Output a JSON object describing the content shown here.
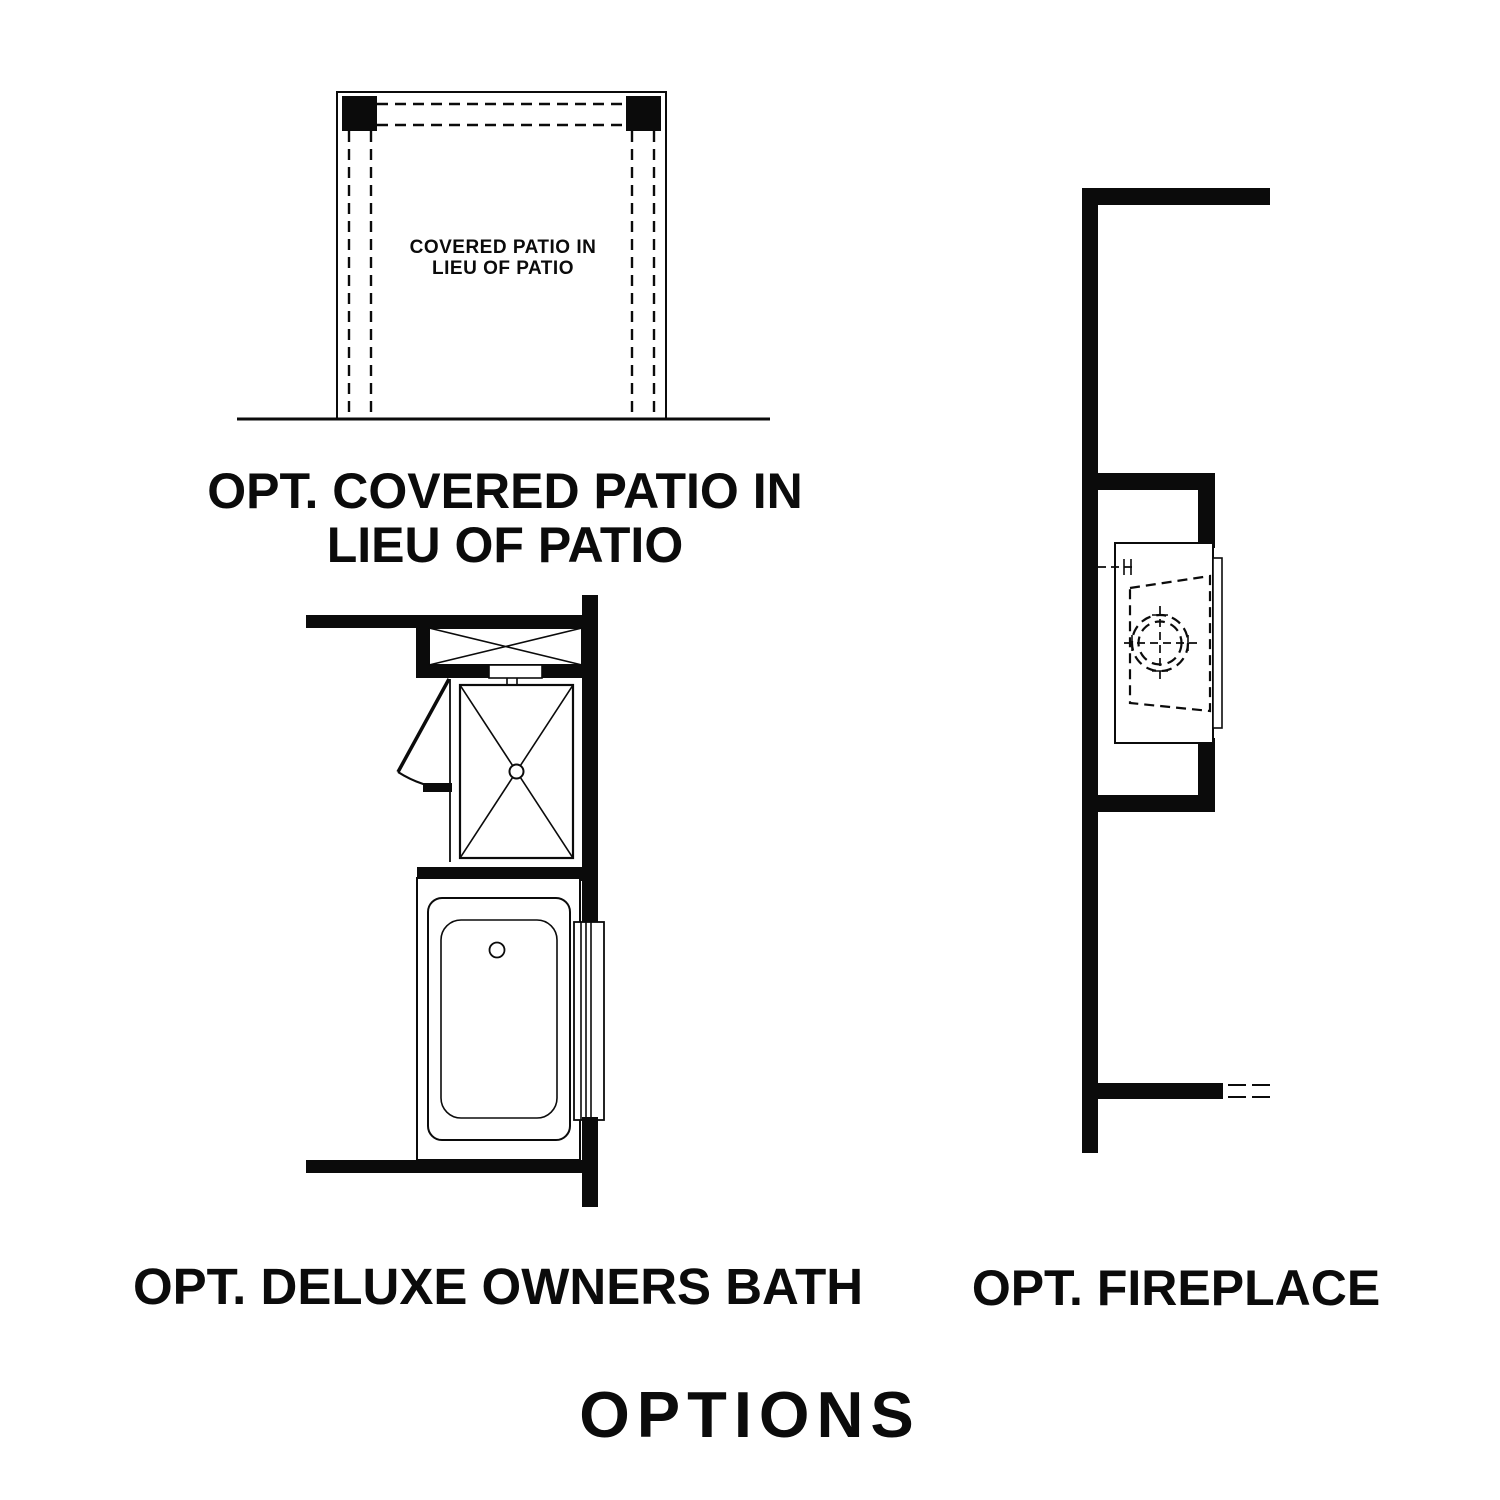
{
  "colors": {
    "ink": "#0b0b0b",
    "background": "#ffffff"
  },
  "title": "OPTIONS",
  "patio": {
    "label_line1": "COVERED PATIO IN",
    "label_line2": "LIEU OF PATIO",
    "caption_line1": "OPT. COVERED PATIO IN",
    "caption_line2": "LIEU OF PATIO"
  },
  "bath": {
    "caption": "OPT. DELUXE OWNERS BATH"
  },
  "fireplace": {
    "caption": "OPT. FIREPLACE"
  }
}
